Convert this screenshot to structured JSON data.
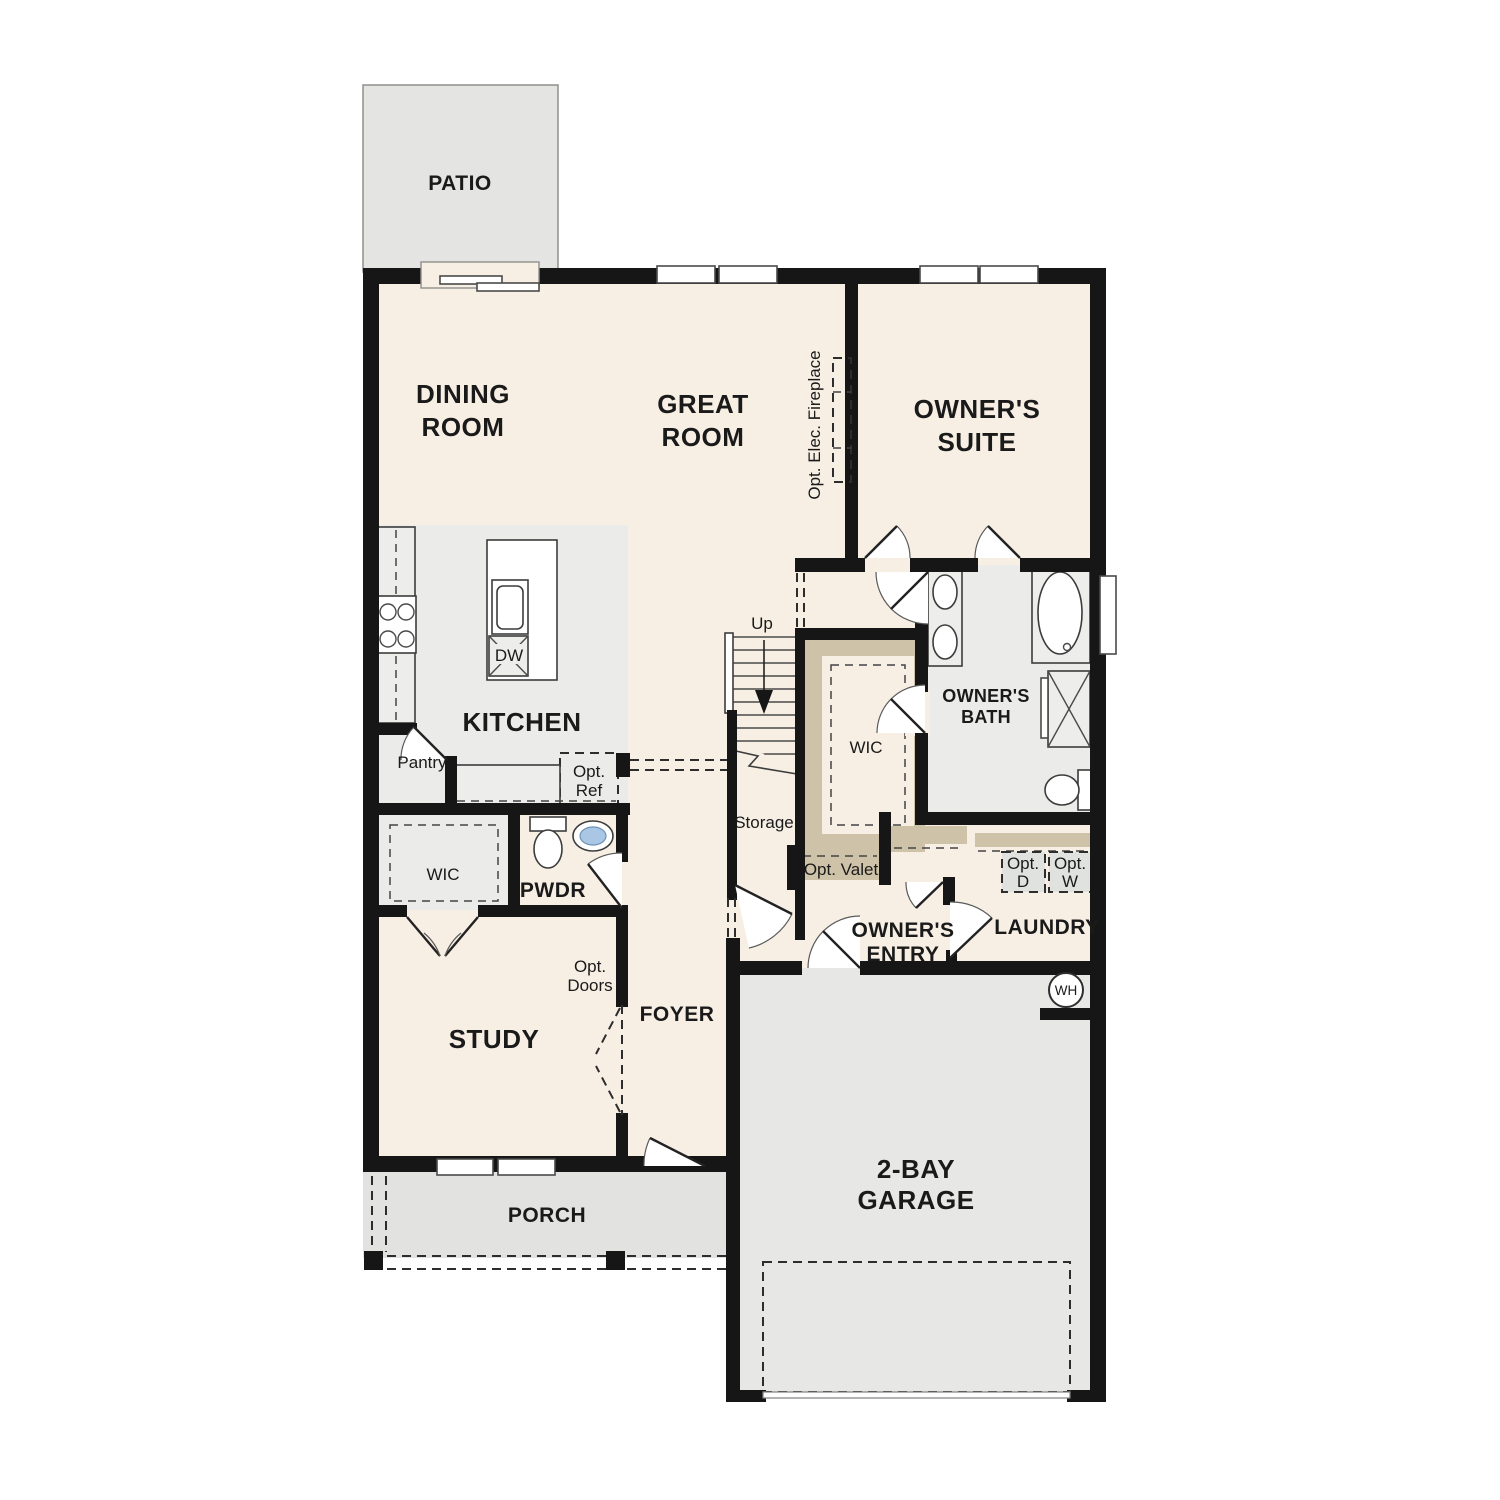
{
  "labels": {
    "patio": "PATIO",
    "dining_l1": "DINING",
    "dining_l2": "ROOM",
    "great_l1": "GREAT",
    "great_l2": "ROOM",
    "suite_l1": "OWNER'S",
    "suite_l2": "SUITE",
    "kitchen": "KITCHEN",
    "pantry": "Pantry",
    "opt_ref_l1": "Opt.",
    "opt_ref_l2": "Ref",
    "dw": "DW",
    "up": "Up",
    "storage": "Storage",
    "wic_owner": "WIC",
    "bath_l1": "OWNER'S",
    "bath_l2": "BATH",
    "opt_valet": "Opt. Valet",
    "pwdr": "PWDR",
    "wic_study": "WIC",
    "study": "STUDY",
    "opt_doors_l1": "Opt.",
    "opt_doors_l2": "Doors",
    "foyer": "FOYER",
    "entry_l1": "OWNER'S",
    "entry_l2": "ENTRY",
    "laundry": "LAUNDRY",
    "opt_d_l1": "Opt.",
    "opt_d_l2": "D",
    "opt_w_l1": "Opt.",
    "opt_w_l2": "W",
    "wh": "WH",
    "garage_l1": "2-BAY",
    "garage_l2": "GARAGE",
    "porch": "PORCH",
    "fireplace": "Opt. Elec. Fireplace"
  },
  "colors": {
    "wall": "#161616",
    "interior_cream": "#f7efe4",
    "floor_gray": "#ebebe9",
    "patio_gray": "#e4e4e2",
    "porch_gray": "#e2e2e0",
    "garage_gray": "#e7e7e5",
    "shelving_tan": "#cec2a9",
    "sink_blue": "#a9c7e4"
  }
}
